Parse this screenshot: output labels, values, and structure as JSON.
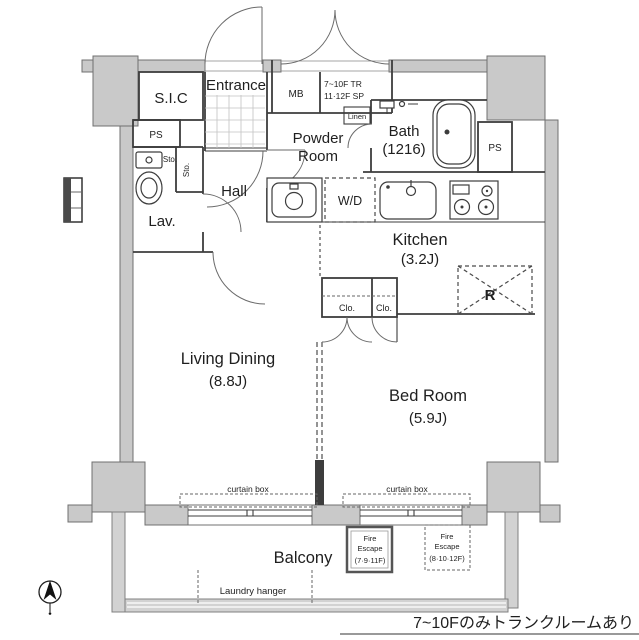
{
  "floorplan": {
    "rooms": {
      "sic": {
        "label": "S.I.C"
      },
      "entrance": {
        "label": "Entrance"
      },
      "mb": {
        "label": "MB"
      },
      "trunk": {
        "line1": "7~10F TR",
        "line2": "11·12F SP"
      },
      "ps_left": {
        "label": "PS"
      },
      "ps_right": {
        "label": "PS"
      },
      "sto_upper": {
        "label": "Sto."
      },
      "sto_closet": {
        "label": "Sto."
      },
      "lavatory": {
        "label": "Lav."
      },
      "hall": {
        "label": "Hall"
      },
      "powder_room": {
        "line1": "Powder",
        "line2": "Room"
      },
      "linen": {
        "label": "Linen"
      },
      "bath": {
        "line1": "Bath",
        "line2": "(1216)"
      },
      "washer_dryer": {
        "label": "W/D"
      },
      "kitchen": {
        "line1": "Kitchen",
        "line2": "(3.2J)"
      },
      "refrigerator": {
        "label": "R"
      },
      "closet_left": {
        "label": "Clo."
      },
      "closet_right": {
        "label": "Clo."
      },
      "living_dining": {
        "line1": "Living Dining",
        "line2": "(8.8J)"
      },
      "bedroom": {
        "line1": "Bed Room",
        "line2": "(5.9J)"
      },
      "balcony": {
        "label": "Balcony"
      }
    },
    "annotations": {
      "curtain_box_living": "curtain box",
      "curtain_box_bedroom": "curtain box",
      "fire_escape_odd": {
        "line1": "Fire",
        "line2": "Escape",
        "line3": "(7·9·11F)"
      },
      "fire_escape_even": {
        "line1": "Fire",
        "line2": "Escape",
        "line3": "(8·10·12F)"
      },
      "laundry_hanger": "Laundry hanger",
      "footnote": "7~10Fのみトランクルームあり"
    },
    "colors": {
      "wall_fill": "#c9c9c9",
      "line": "#3d3d3d",
      "background": "#ffffff"
    }
  }
}
